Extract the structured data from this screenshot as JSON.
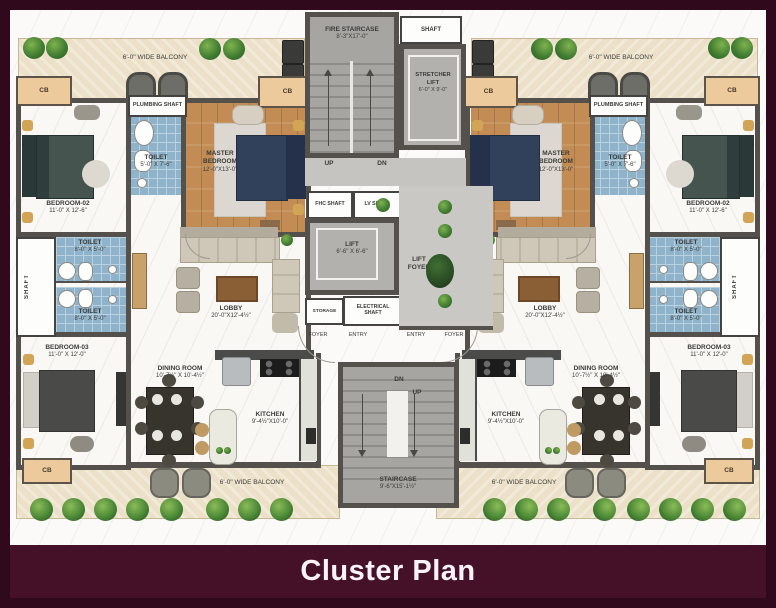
{
  "title_bar": {
    "title": "Cluster Plan"
  },
  "palette": {
    "frame": "#31091d",
    "title_band": "#441129",
    "title_text": "#fbf3f8",
    "wall": "#54514c",
    "tile_blue": "#8fb3ca",
    "wood": "#c28c54",
    "balcony_cream": "#ece1c8",
    "stair_grey": "#a7a5a1",
    "label_text": "#3b3b39",
    "plant_green": "#4c8a37",
    "cupboard_tan": "#ecca9c"
  },
  "core": {
    "fire_staircase": {
      "label": "FIRE STAIRCASE",
      "dims": "8'-3\"X17'-0\""
    },
    "shaft_top": "SHAFT",
    "stretcher": {
      "l1": "STRETCHER",
      "l2": "LIFT",
      "dims": "6'-0\" X 9'-0\""
    },
    "up": "UP",
    "dn": "DN",
    "fhc": "FHC SHAFT",
    "lv": "LV SHAFT",
    "lift": {
      "label": "LIFT",
      "dims": "6'-6\" X 6'-6\""
    },
    "storage": "STORAGE",
    "electrical": {
      "l1": "ELECTRICAL",
      "l2": "SHAFT"
    },
    "lift_foyer": {
      "l1": "LIFT",
      "l2": "FOYER"
    },
    "foyer": "FOYER",
    "entry": "ENTRY",
    "staircase": {
      "label": "STAIRCASE",
      "dims": "9'-6\"X15'-1½\""
    }
  },
  "unit": {
    "balcony": "6'-0\" WIDE BALCONY",
    "cb": "CB",
    "plumbing_shaft": "PLUMBING SHAFT",
    "master": {
      "l1": "MASTER",
      "l2": "BEDROOM",
      "dims": "12'-0\"X13'-0\""
    },
    "toilet_master": {
      "label": "TOILET",
      "dims": "5'-0\" X 7'-6\""
    },
    "bedroom_02": {
      "label": "BEDROOM-02",
      "dims": "11'-0\" X 12'-6\""
    },
    "toilet_small": {
      "label": "TOILET",
      "dims": "8'-0\" X 5'-0\""
    },
    "shaft_side": "SHAFT",
    "bedroom_03": {
      "label": "BEDROOM-03",
      "dims": "11'-0\" X 12'-0\""
    },
    "lobby": {
      "label": "LOBBY",
      "dims": "20'-0\"X12'-4½\""
    },
    "dining": {
      "label": "DINING ROOM",
      "dims": "10'-7½\" X 10'-4½\""
    },
    "kitchen": {
      "label": "KITCHEN",
      "dims": "9'-4½\"X10'-0\""
    }
  }
}
